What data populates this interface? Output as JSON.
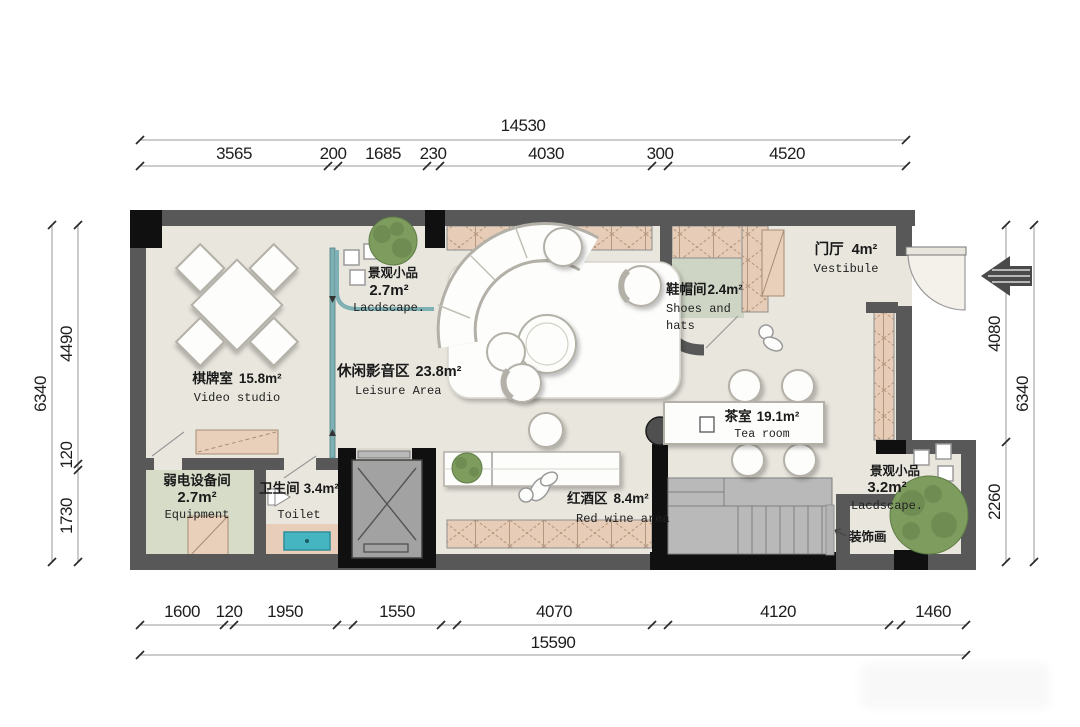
{
  "colors": {
    "wall": "#585858",
    "black": "#101010",
    "floor": "#e9e6de",
    "equip-floor": "#d7dcc9",
    "shoes-floor": "#ced5c5",
    "toilet-strip": "#e8ceba",
    "hatch-bg": "#e7cdb7",
    "hatch-line": "#b5977d",
    "cabinet": "#e9d0bb",
    "glass": "#7fb0b4",
    "tree": "#7d9c5e",
    "tree-dark": "#5f7d47",
    "white": "#fdfdfc",
    "furniture-stroke": "#b3b0a7",
    "step": "#b9b9b9",
    "elevator": "#a2a2a2",
    "sink": "#45b5c2",
    "dim-line": "#9a9a9a",
    "dim-text": "#1d1d1d",
    "label": "#1a1a1a"
  },
  "dims": {
    "top": {
      "overall": "14530",
      "segments": [
        "3565",
        "200",
        "1685",
        "230",
        "4030",
        "300",
        "4520"
      ]
    },
    "bottom": {
      "overall": "15590",
      "segments": [
        "1600",
        "120",
        "1950",
        "1550",
        "4070",
        "4120",
        "1460"
      ]
    },
    "left": {
      "overall": "6340",
      "segments": [
        "4490",
        "120",
        "1730"
      ]
    },
    "right": {
      "overall": "6340",
      "segments": [
        "4080",
        "2260"
      ]
    }
  },
  "rooms": {
    "video_studio": {
      "zh": "棋牌室",
      "area": "15.8m²",
      "en": "Video studio"
    },
    "landscape_top": {
      "zh": "景观小品",
      "area": "2.7m²",
      "en": "Lacdscape."
    },
    "leisure": {
      "zh": "休闲影音区",
      "area": "23.8m²",
      "en": "Leisure Area"
    },
    "shoes": {
      "zh": "鞋帽间",
      "area": "2.4m²",
      "en_line1": "Shoes and",
      "en_line2": "hats"
    },
    "vestibule": {
      "zh": "门厅",
      "area": "4m²",
      "en": "Vestibule"
    },
    "tea_room": {
      "zh": "茶室",
      "area": "19.1m²",
      "en": "Tea room"
    },
    "red_wine": {
      "zh": "红酒区",
      "area": "8.4m²",
      "en": "Red wine area"
    },
    "toilet": {
      "zh": "卫生间",
      "area": "3.4m²",
      "en": "Toilet"
    },
    "equipment": {
      "zh": "弱电设备间",
      "area": "2.7m²",
      "en": "Equipment"
    },
    "landscape_bottom": {
      "zh": "景观小品",
      "area": "3.2m²",
      "en": "Lacdscape."
    },
    "decor_painting": {
      "zh": "装饰画"
    }
  }
}
